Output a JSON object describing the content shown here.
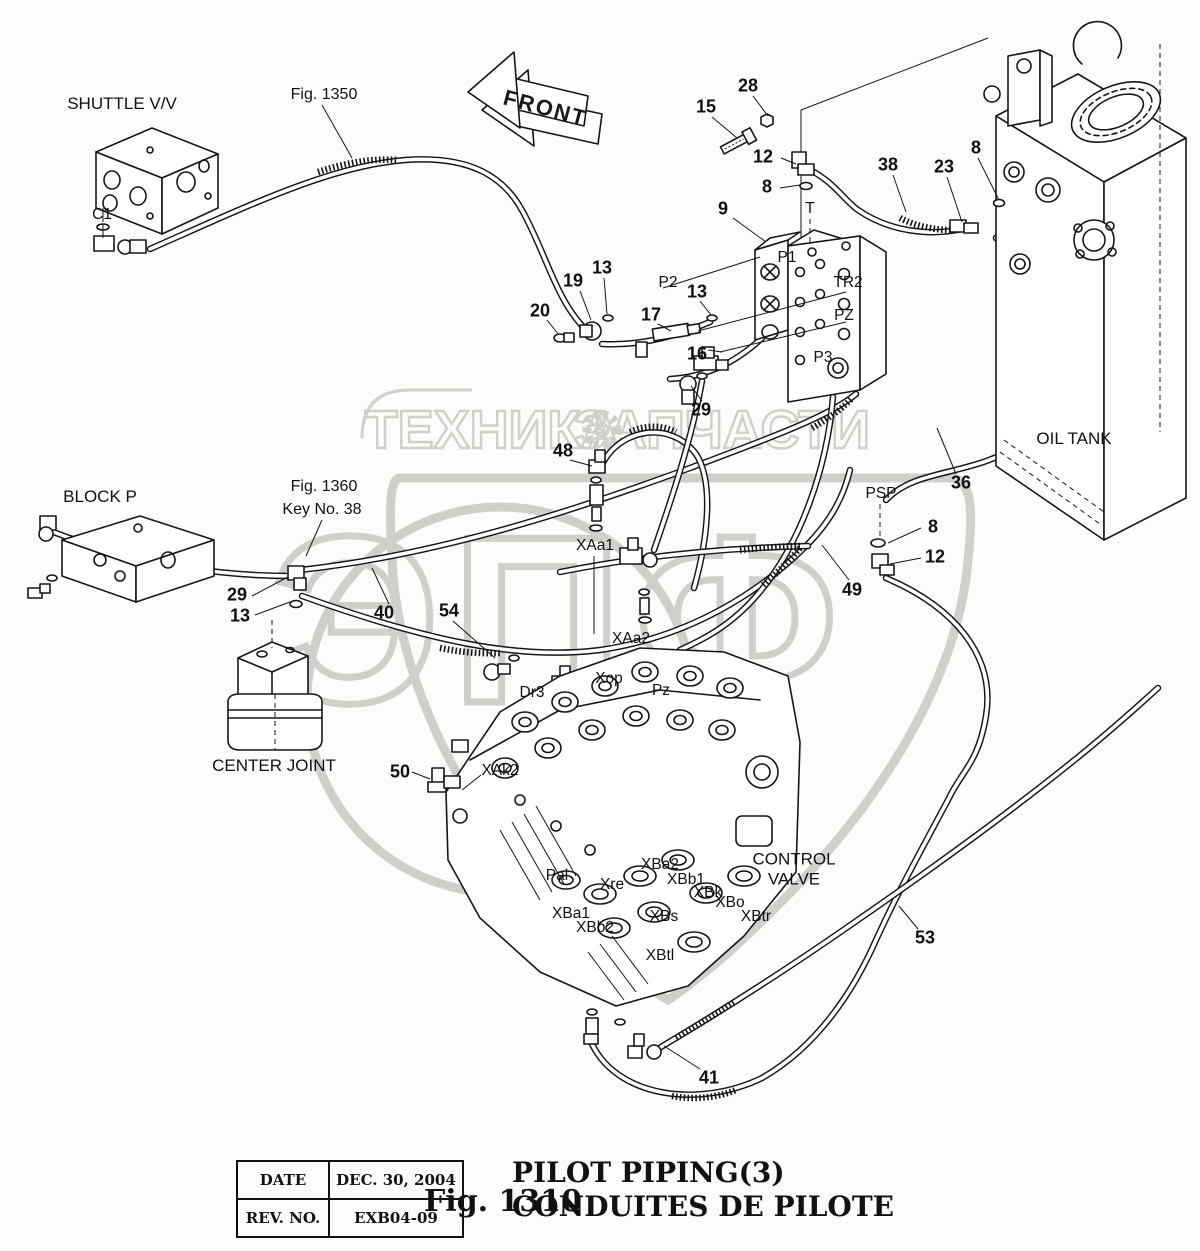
{
  "watermark": {
    "left_text": "ТЕХНИКА",
    "right_text": "ЗАПЧАСТИ",
    "big_text": "ЭПФ",
    "color": "#c8c8c3",
    "gear_icon": "gear"
  },
  "front_arrow": {
    "label": "FRONT"
  },
  "title_block": {
    "date_label": "DATE",
    "date_value": "DEC. 30, 2004",
    "rev_label": "REV. NO.",
    "rev_value": "EXB04-09"
  },
  "caption": {
    "fig": "Fig. 1310",
    "title_en": "PILOT PIPING(3)",
    "title_fr": "CONDUITES DE PILOTE"
  },
  "labels": [
    {
      "name": "component-shuttle-valve",
      "cls": "comp",
      "text": "SHUTTLE V/V",
      "x": 122,
      "y": 104
    },
    {
      "name": "figref-1350",
      "cls": "figref",
      "text": "Fig. 1350",
      "x": 324,
      "y": 95
    },
    {
      "name": "component-block-p",
      "cls": "comp",
      "text": "BLOCK P",
      "x": 100,
      "y": 497
    },
    {
      "name": "figref-1360",
      "cls": "figref",
      "text": "Fig. 1360",
      "x": 324,
      "y": 487
    },
    {
      "name": "figref-key-no-38",
      "cls": "figref",
      "text": "Key No. 38",
      "x": 322,
      "y": 510
    },
    {
      "name": "component-center-joint",
      "cls": "comp",
      "text": "CENTER JOINT",
      "x": 274,
      "y": 766
    },
    {
      "name": "component-oil-tank",
      "cls": "comp",
      "text": "OIL TANK",
      "x": 1074,
      "y": 439
    },
    {
      "name": "component-control-valve",
      "cls": "comp",
      "text": "CONTROL\nVALVE",
      "x": 794,
      "y": 869
    },
    {
      "name": "callout-15",
      "cls": "num",
      "text": "15",
      "x": 706,
      "y": 107
    },
    {
      "name": "callout-28",
      "cls": "num",
      "text": "28",
      "x": 748,
      "y": 86
    },
    {
      "name": "callout-12-top",
      "cls": "num",
      "text": "12",
      "x": 763,
      "y": 157
    },
    {
      "name": "callout-8-top",
      "cls": "num",
      "text": "8",
      "x": 767,
      "y": 187
    },
    {
      "name": "callout-9",
      "cls": "num",
      "text": "9",
      "x": 723,
      "y": 209
    },
    {
      "name": "callout-38",
      "cls": "num",
      "text": "38",
      "x": 888,
      "y": 165
    },
    {
      "name": "callout-23",
      "cls": "num",
      "text": "23",
      "x": 944,
      "y": 167
    },
    {
      "name": "callout-8-tank",
      "cls": "num",
      "text": "8",
      "x": 976,
      "y": 148
    },
    {
      "name": "callout-19",
      "cls": "num",
      "text": "19",
      "x": 573,
      "y": 281
    },
    {
      "name": "callout-13-a",
      "cls": "num",
      "text": "13",
      "x": 602,
      "y": 268
    },
    {
      "name": "callout-20",
      "cls": "num",
      "text": "20",
      "x": 540,
      "y": 311
    },
    {
      "name": "callout-13-b",
      "cls": "num",
      "text": "13",
      "x": 697,
      "y": 292
    },
    {
      "name": "callout-17",
      "cls": "num",
      "text": "17",
      "x": 651,
      "y": 315
    },
    {
      "name": "callout-16",
      "cls": "num",
      "text": "16",
      "x": 697,
      "y": 354
    },
    {
      "name": "callout-29-a",
      "cls": "num",
      "text": "29",
      "x": 701,
      "y": 410
    },
    {
      "name": "callout-48",
      "cls": "num",
      "text": "48",
      "x": 563,
      "y": 451
    },
    {
      "name": "callout-29-b",
      "cls": "num",
      "text": "29",
      "x": 237,
      "y": 595
    },
    {
      "name": "callout-13-c",
      "cls": "num",
      "text": "13",
      "x": 240,
      "y": 616
    },
    {
      "name": "callout-40",
      "cls": "num",
      "text": "40",
      "x": 384,
      "y": 613
    },
    {
      "name": "callout-54",
      "cls": "num",
      "text": "54",
      "x": 449,
      "y": 611
    },
    {
      "name": "callout-36",
      "cls": "num",
      "text": "36",
      "x": 961,
      "y": 483
    },
    {
      "name": "callout-49",
      "cls": "num",
      "text": "49",
      "x": 852,
      "y": 590
    },
    {
      "name": "callout-8-psp",
      "cls": "num",
      "text": "8",
      "x": 933,
      "y": 527
    },
    {
      "name": "callout-12-psp",
      "cls": "num",
      "text": "12",
      "x": 935,
      "y": 557
    },
    {
      "name": "callout-50",
      "cls": "num",
      "text": "50",
      "x": 400,
      "y": 772
    },
    {
      "name": "callout-53",
      "cls": "num",
      "text": "53",
      "x": 925,
      "y": 938
    },
    {
      "name": "callout-41",
      "cls": "num",
      "text": "41",
      "x": 709,
      "y": 1078
    },
    {
      "name": "port-c1",
      "cls": "port",
      "text": "C1",
      "x": 102,
      "y": 215
    },
    {
      "name": "port-t",
      "cls": "port",
      "text": "T",
      "x": 810,
      "y": 209
    },
    {
      "name": "port-p1",
      "cls": "port",
      "text": "P1",
      "x": 787,
      "y": 258
    },
    {
      "name": "port-tr2",
      "cls": "port",
      "text": "TR2",
      "x": 848,
      "y": 283
    },
    {
      "name": "port-pz-manifold",
      "cls": "port",
      "text": "PZ",
      "x": 844,
      "y": 316
    },
    {
      "name": "port-p3",
      "cls": "port",
      "text": "P3",
      "x": 823,
      "y": 358
    },
    {
      "name": "port-p2",
      "cls": "port",
      "text": "P2",
      "x": 668,
      "y": 283
    },
    {
      "name": "port-psp",
      "cls": "port",
      "text": "PSP",
      "x": 881,
      "y": 494
    },
    {
      "name": "port-xaa1",
      "cls": "port",
      "text": "XAa1",
      "x": 595,
      "y": 546
    },
    {
      "name": "port-xaa2",
      "cls": "port",
      "text": "XAa2",
      "x": 631,
      "y": 639
    },
    {
      "name": "port-xop",
      "cls": "port",
      "text": "Xop",
      "x": 609,
      "y": 679
    },
    {
      "name": "port-pz-valve",
      "cls": "port",
      "text": "Pz",
      "x": 661,
      "y": 691
    },
    {
      "name": "port-dr3",
      "cls": "port",
      "text": "Dr3",
      "x": 532,
      "y": 693
    },
    {
      "name": "port-xak2",
      "cls": "port",
      "text": "XAk2",
      "x": 500,
      "y": 771
    },
    {
      "name": "port-pal",
      "cls": "port",
      "text": "Pal",
      "x": 557,
      "y": 876
    },
    {
      "name": "port-xre",
      "cls": "port",
      "text": "Xre",
      "x": 612,
      "y": 885
    },
    {
      "name": "port-xba2",
      "cls": "port",
      "text": "XBa2",
      "x": 660,
      "y": 865
    },
    {
      "name": "port-xbb1",
      "cls": "port",
      "text": "XBb1",
      "x": 686,
      "y": 880
    },
    {
      "name": "port-xbk",
      "cls": "port",
      "text": "XBk",
      "x": 708,
      "y": 893
    },
    {
      "name": "port-xbo",
      "cls": "port",
      "text": "XBo",
      "x": 730,
      "y": 903
    },
    {
      "name": "port-xbtr",
      "cls": "port",
      "text": "XBtr",
      "x": 756,
      "y": 917
    },
    {
      "name": "port-xba1",
      "cls": "port",
      "text": "XBa1",
      "x": 571,
      "y": 914
    },
    {
      "name": "port-xbb2",
      "cls": "port",
      "text": "XBb2",
      "x": 595,
      "y": 928
    },
    {
      "name": "port-xbs",
      "cls": "port",
      "text": "XBs",
      "x": 664,
      "y": 917
    },
    {
      "name": "port-xbtl",
      "cls": "port",
      "text": "XBtl",
      "x": 660,
      "y": 956
    }
  ]
}
